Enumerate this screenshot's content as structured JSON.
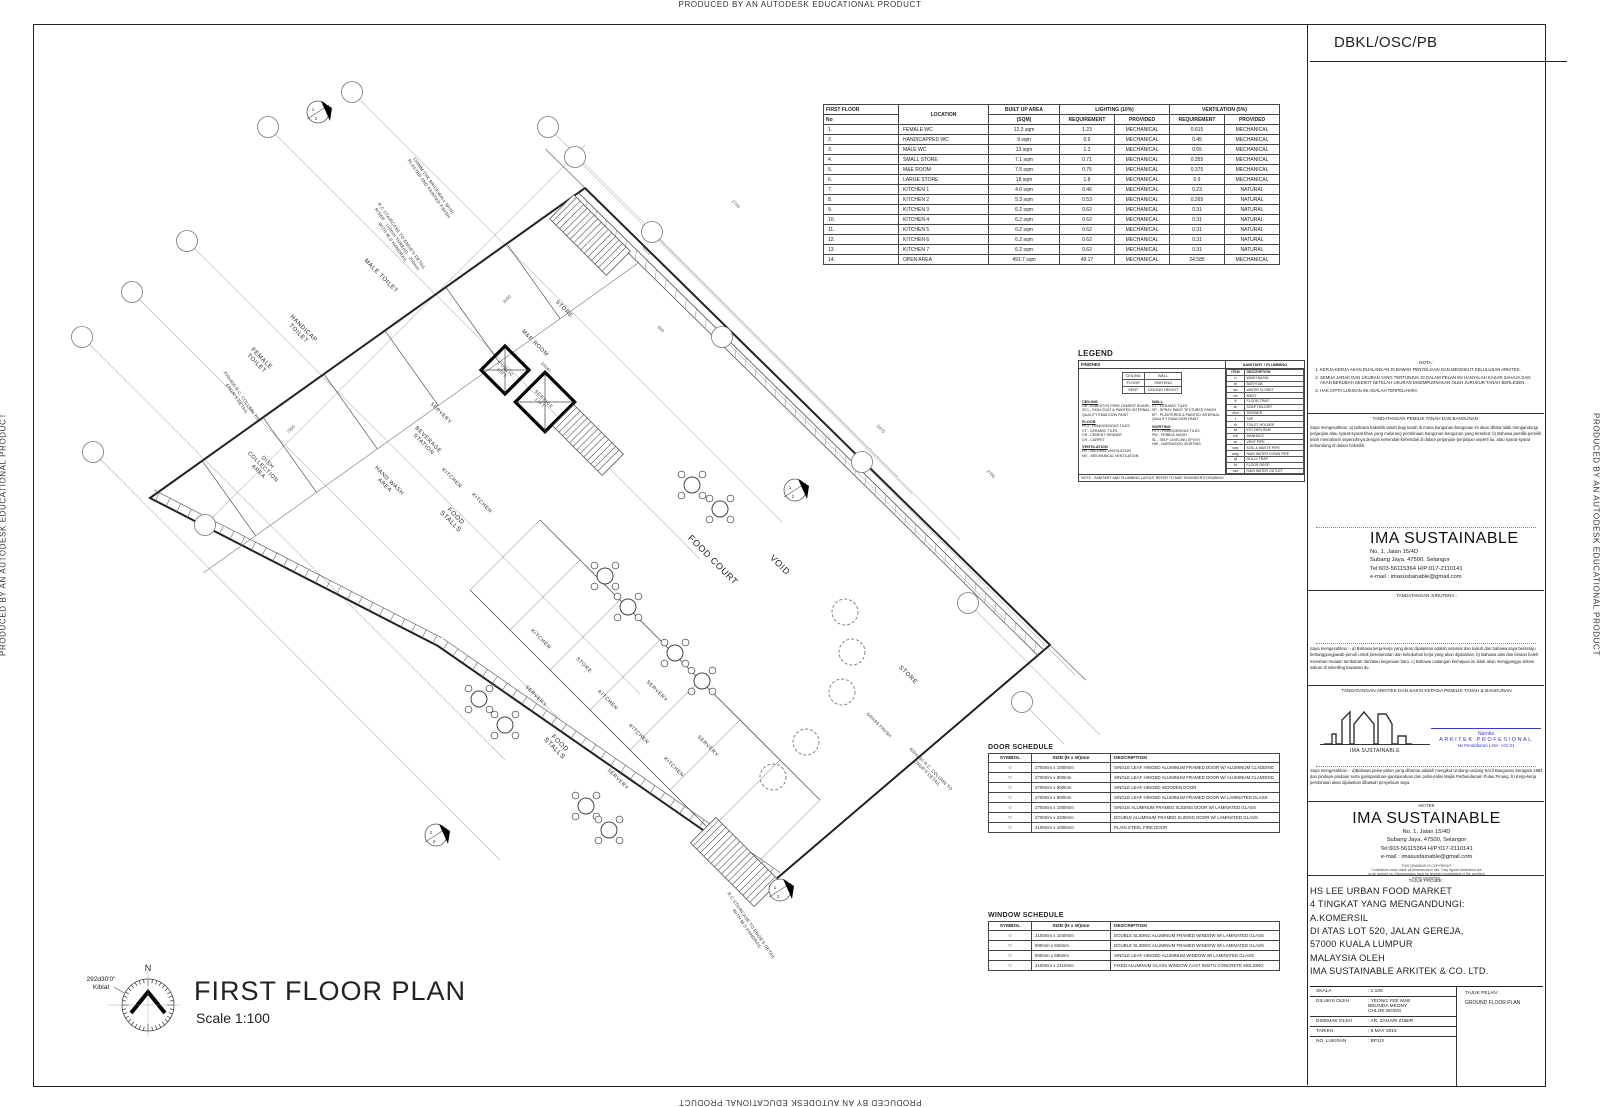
{
  "edge_text": "PRODUCED BY AN AUTODESK EDUCATIONAL PRODUCT",
  "title_block": {
    "header": "DBKL/OSC/PB",
    "nota_title": "NOTA :",
    "nota_items": [
      "KERJA-KERJA AKAN DIJALANKAN DI BAWAH PENYELIAAN DAN MENGIKUT KELULUSAN ARKITEK.",
      "SEMUA JARAK DAN UKURAN YANG TERTUNJUK DI DALAM PELAN INI HANYALAH KASAR SAHAJA DAN AKAN BERUBAH SEDIKIT SETELAH UKURAN DISEMPURNAKAN OLEH JURUKUR TANAH BERLESEN.",
      "HAK CIPTA LUKISAN INI ADALAH TERPELIHARA"
    ],
    "owner_title": "TANDATANGAN PEMILIK TANAH DAN BANGUNAN :",
    "owner_para": "Saya mengesahkan:  a) bahawa hakmilik tanah bagi tanah di mana bangunan-bangunan ini akan dibina tidak  mengandungi perjanjian atau syarat-syarat khas yang melarang pembinaan bangunan-bangunan yang tersebut; b) Bahawa pemilik-pemilik telah memahami sepenuhnya dengan kehendak-kehendak di dalam perjanjian-perjanjian seperti itu, atau syarat-syarat terkandung di dalam hakmilik.",
    "firm_name": "IMA SUSTAINABLE",
    "firm_address": [
      "No. 1, Jalan 15/4D",
      "Subang Jaya, 47500, Selangor",
      "Tel:603-56115364  H/P:017-2110141",
      "e-mail : imasustainable@gmail.com"
    ],
    "jurutera_title": "TANDATANGAN JURUTERA :",
    "engineer_para": "Saya mengesahkan :-  a) Bahawa kerja-kerja yang akan dijalankan adalah selamat dan kukuh dan bahawa saya bersetuju  bertanggungjawab penuh untuk keselamatan dan kekukuhan kerja yang akan dijalankan.  b) Bahawa alas dan binaan boleh menahan muatan tambahan dan/atau kegunaan baru.  c) Bahawa cadangan kemajuan ini tidak akan mengganggu sistem saliran di sekeliling kawasan itu.",
    "arkitek_saksi_title": "TANDATANGAN ARKITEK DAN SAKSI KEPADA PEMILIK TANAH & BANGUNAN",
    "logo_caption": "IMA SUSTAINABLE",
    "registration": {
      "name": "Naroka",
      "line2": "ARKITEK PROFESIONAL",
      "line3": "No Pendaftaran LAM : A/O 01",
      "color": "#3a3ac8"
    },
    "architect_para": "Saya mengesahkan :-  a)Bahawa pelan-pelan yang dihantar adalah mengikut Undang-undang Kecil Bangunan Seragam 1984 dan pindaan-pindaan serta garispanduan-garispanduan dan polisi-polisi Majlis Perbandaraan Pulau Pinang.  b) Kerja-kerja pembinaan akan dijalankan dibawah penyeliaan saya.",
    "akitek_label": "AKITEK",
    "copyright_lines": [
      "THIS DRAWING IS COPYRIGHT",
      "Contractors must check all dimensions in site. Only figured dimension are",
      "to be worked on. Discrepancies must be reported immediately to the architect",
      "before proceeding."
    ],
    "project_title_label": "TAJUK PROJEK :",
    "project_lines": [
      "HS LEE URBAN FOOD MARKET",
      "4 TINGKAT YANG MENGANDUNGI:",
      "A.KOMERSIL",
      "DI ATAS LOT 520, JALAN GEREJA,",
      "57000 KUALA LUMPUR",
      "MALAYSIA OLEH",
      "IMA SUSTAINABLE ARKITEK & CO. LTD."
    ],
    "meta_rows": [
      [
        "SKALA",
        "1:100"
      ],
      [
        "DILUKIS OLEH",
        "YEONG YEE MAE\nBELINDA MKONY\nCHLOE WONG"
      ],
      [
        "DISEMAK OLEH",
        "AR. ZAHARI ZUBIR"
      ],
      [
        "TARIKH",
        "6 MAY 2015"
      ],
      [
        "NO. LUKISAN",
        "BP1/3"
      ]
    ],
    "tajuk_pelan_label": "TAJUK PELAN :",
    "tajuk_pelan_value": "GROUND FLOOR PLAN"
  },
  "area_table": {
    "h_first_floor": "FIRST FLOOR",
    "h_no": "No",
    "h_location": "LOCATION",
    "h_area1": "BUILT UP AREA",
    "h_area2": "(SQM)",
    "h_lighting": "LIGHTING (10%)",
    "h_vent": "VENTILATION (5%)",
    "h_req": "REQUIREMENT",
    "h_prov": "PROVIDED",
    "rows": [
      [
        "1.",
        "FEMALE WC",
        "12.3 sqm",
        "1.23",
        "MECHANICAL",
        "0.615",
        "MECHANICAL"
      ],
      [
        "2.",
        "HANDICAPPED WC",
        "9 sqm",
        "0.9",
        "MECHANICAL",
        "0.45",
        "MECHANICAL"
      ],
      [
        "3.",
        "MALE WC",
        "13 sqm",
        "1.3",
        "MECHANICAL",
        "0.65",
        "MECHANICAL"
      ],
      [
        "4.",
        "SMALL STORE",
        "7.1 sqm",
        "0.71",
        "MECHANICAL",
        "0.355",
        "MECHANICAL"
      ],
      [
        "5.",
        "M&E ROOM",
        "7.5 sqm",
        "0.75",
        "MECHANICAL",
        "0.375",
        "MECHANICAL"
      ],
      [
        "6.",
        "LARGE STORE",
        "18 sqm",
        "1.8",
        "MECHANICAL",
        "0.9",
        "MECHANICAL"
      ],
      [
        "7.",
        "KITCHEN 1",
        "4.6 sqm",
        "0.46",
        "MECHANICAL",
        "0.23",
        "NATURAL"
      ],
      [
        "8.",
        "KITCHEN 2",
        "5.3 sqm",
        "0.53",
        "MECHANICAL",
        "0.265",
        "NATURAL"
      ],
      [
        "9.",
        "KITCHEN 3",
        "6.2 sqm",
        "0.62",
        "MECHANICAL",
        "0.31",
        "NATURAL"
      ],
      [
        "10.",
        "KITCHEN 4",
        "6.2 sqm",
        "0.62",
        "MECHANICAL",
        "0.31",
        "NATURAL"
      ],
      [
        "11.",
        "KITCHEN 5",
        "6.2 sqm",
        "0.62",
        "MECHANICAL",
        "0.31",
        "NATURAL"
      ],
      [
        "12.",
        "KITCHEN 6",
        "6.2 sqm",
        "0.62",
        "MECHANICAL",
        "0.31",
        "NATURAL"
      ],
      [
        "13.",
        "KITCHEN 7",
        "6.2 sqm",
        "0.62",
        "MECHANICAL",
        "0.31",
        "NATURAL"
      ],
      [
        "14.",
        "OPEN AREA",
        "491.7 sqm",
        "49.17",
        "MECHANICAL",
        "24.585",
        "MECHANICAL"
      ]
    ]
  },
  "legend": {
    "title": "LEGEND",
    "finishes_header": "FINISHES",
    "matrix": [
      [
        "CEILING",
        "WALL"
      ],
      [
        "FLOOR",
        "SKIRTING"
      ],
      [
        "VENT",
        "CEILING HEIGHT"
      ]
    ],
    "col_a": [
      {
        "title": "CEILING",
        "items": [
          "CB - ASBESTOS FREE CEMENT BOARD",
          "SC1 - SKIN COAT & PAINTED INTERNAL QUALITY EMULSION PAINT"
        ]
      },
      {
        "title": "FLOOR",
        "items": [
          "HT3 - HOMOGENOUS TILES",
          "CT - CERAMIC TILES",
          "CR - CEMENT RENDER",
          "CH - CARPET"
        ]
      },
      {
        "title": "VENTILATION",
        "items": [
          "NV - NATURAL VENTILATION",
          "MV - MECHANICAL VENTILATION"
        ]
      }
    ],
    "col_b": [
      {
        "title": "WALL",
        "items": [
          "CT - CERAMIC TILES",
          "SP - SPRAY PAINT TEXTURED FINISH",
          "EP - PLASTERED & PAINTED INTERNAL QUALITY EMULSION PAINT"
        ]
      },
      {
        "title": "SKIRTING",
        "items": [
          "HT3 - HOMOGENOUS TILES",
          "PW - PEBBLE WASH",
          "SL - SELF LEVELING EPOXY",
          "HW - HARDWOOD SKIRTING"
        ]
      }
    ],
    "sanitary": {
      "header": "SANITARY / PLUMBING",
      "h_item": "ITEM",
      "h_desc": "DESCRIPTION",
      "rows": [
        [
          "b",
          "WASH BASIN"
        ],
        [
          "bt",
          "BATHTUB"
        ],
        [
          "wc",
          "WATER CLOSET"
        ],
        [
          "bd",
          "BIDET"
        ],
        [
          "ft",
          "FLOOR TRAP"
        ],
        [
          "sh",
          "SOAP HOLDER"
        ],
        [
          "shw",
          "SHOWER"
        ],
        [
          "t",
          "TAP"
        ],
        [
          "th",
          "TOILET HOLDER"
        ],
        [
          "ks",
          "KITCHEN SINK"
        ],
        [
          "mh",
          "MANHOLE"
        ],
        [
          "vp",
          "VENT PIPE"
        ],
        [
          "swp",
          "SOIL & WASTE PIPE"
        ],
        [
          "rwdp",
          "RAIN WATER DOWN PIPE"
        ],
        [
          "gt",
          "GULLY TRAP"
        ],
        [
          "fd",
          "FLOOR DROP"
        ],
        [
          "rwo",
          "RAIN WATER OUTLET"
        ]
      ]
    },
    "note": "NOTE : SANITARY AND PLUMBING LAYOUT REFER TO M&E ENGINEER'S DRAWING"
  },
  "door_schedule": {
    "title": "DOOR SCHEDULE",
    "h_symbol": "SYMBOL",
    "h_size": "SIZE (H x W)mm",
    "h_desc": "DESCRIPTION",
    "rows": [
      [
        "○",
        "2700mm x 1000mm",
        "SINGLE LEAF HINGED ALUMINUM FRAMED DOOR W/ ALUMINUM CLADDING"
      ],
      [
        "○",
        "2700mm x 800mm",
        "SINGLE LEAF HINGED ALUMINUM FRAMED DOOR W/ ALUMINUM CLADDING"
      ],
      [
        "○",
        "2700mm x 900mm",
        "SINGLE LEAF HINGED WOODEN DOOR"
      ],
      [
        "○",
        "2700mm x 900mm",
        "SINGLE LEAF HINGED ALUMINUM FRAMED DOOR W/ LAMINATED GLASS"
      ],
      [
        "○",
        "2700mm x 1000mm",
        "SINGLE ALUMINUM FRAMED SLIDING DOOR W/ LAMINATED GLASS"
      ],
      [
        "○",
        "2700mm x 2200mm",
        "DOUBLE ALUMINUM FRAMED SLIDING DOOR W/ LAMINATED GLASS"
      ],
      [
        "○",
        "2100mm x 1000mm",
        "PLAIN STEEL FIRE DOOR"
      ]
    ]
  },
  "window_schedule": {
    "title": "WINDOW SCHEDULE",
    "h_symbol": "SYMBOL",
    "h_size": "SIZE (H x W)mm",
    "h_desc": "DESCRIPTION",
    "rows": [
      [
        "○",
        "2100mm x 1040mm",
        "DOUBLE SLIDING ALUMINUM FRAMED WINDOW W/ LAMINATED GLASS"
      ],
      [
        "○",
        "900mm x 840mm",
        "DOUBLE SLIDING ALUMINUM FRAMED WINDOW W/ LAMINATED GLASS"
      ],
      [
        "○",
        "900mm x 580mm",
        "SINGLE LEAF HINGED ALUMINUM WINDOW W/ LAMINATED GLASS"
      ],
      [
        "○",
        "2100mm x 1410mm",
        "FIXED ALUMINUM GLASS WINDOW CAST INSITU CONCRETE MOLDING"
      ]
    ]
  },
  "plan": {
    "title": "FIRST FLOOR PLAN",
    "scale": "Scale 1:100",
    "north_label": "N",
    "kiblat": "292d30'0\"\nKiblat",
    "outline": [
      [
        150,
        498
      ],
      [
        585,
        188
      ],
      [
        1050,
        645
      ],
      [
        775,
        880
      ],
      [
        438,
        646
      ]
    ],
    "labels": [
      {
        "t": "MALE TOILET",
        "x": 380,
        "y": 277,
        "r": 45,
        "s": 6
      },
      {
        "t": "HANDICAP\nTOILET",
        "x": 300,
        "y": 332,
        "r": 45,
        "s": 6
      },
      {
        "t": "FEMALE\nTOILET",
        "x": 258,
        "y": 362,
        "r": 45,
        "s": 6
      },
      {
        "t": "DISH\nCOLLECTION\nAREA",
        "x": 262,
        "y": 468,
        "r": 45,
        "s": 5.5
      },
      {
        "t": "BEVERAGE\nSTATION",
        "x": 425,
        "y": 443,
        "r": 45,
        "s": 5.5
      },
      {
        "t": "HAND WASH\nAREA",
        "x": 386,
        "y": 484,
        "r": 45,
        "s": 5.5
      },
      {
        "t": "SERVERY",
        "x": 440,
        "y": 414,
        "r": 45,
        "s": 5
      },
      {
        "t": "KITCHEN",
        "x": 451,
        "y": 479,
        "r": 45,
        "s": 5
      },
      {
        "t": "KITCHEN",
        "x": 481,
        "y": 504,
        "r": 45,
        "s": 5
      },
      {
        "t": "FOOD\nSTALLS",
        "x": 452,
        "y": 520,
        "r": 45,
        "s": 6.5
      },
      {
        "t": "STORE",
        "x": 563,
        "y": 310,
        "r": 45,
        "s": 5.5
      },
      {
        "t": "M&E ROOM",
        "x": 534,
        "y": 344,
        "r": 45,
        "s": 5.5
      },
      {
        "t": "PUBLIC\nLIFT",
        "x": 503,
        "y": 372,
        "r": 45,
        "s": 4.5
      },
      {
        "t": "SERVICE\nLIFT",
        "x": 541,
        "y": 402,
        "r": 45,
        "s": 4.5
      },
      {
        "t": "FOOD COURT",
        "x": 711,
        "y": 562,
        "r": 45,
        "s": 9
      },
      {
        "t": "VOID",
        "x": 778,
        "y": 567,
        "r": 45,
        "s": 9
      },
      {
        "t": "STORE",
        "x": 907,
        "y": 676,
        "r": 45,
        "s": 6
      },
      {
        "t": "KITCHEN",
        "x": 540,
        "y": 640,
        "r": 45,
        "s": 5
      },
      {
        "t": "STORE",
        "x": 583,
        "y": 666,
        "r": 45,
        "s": 5
      },
      {
        "t": "KITCHEN",
        "x": 607,
        "y": 701,
        "r": 45,
        "s": 5
      },
      {
        "t": "SERVERY",
        "x": 656,
        "y": 692,
        "r": 45,
        "s": 5
      },
      {
        "t": "SERVERY",
        "x": 535,
        "y": 697,
        "r": 45,
        "s": 5
      },
      {
        "t": "KITCHEN",
        "x": 638,
        "y": 735,
        "r": 45,
        "s": 5
      },
      {
        "t": "KITCHEN",
        "x": 673,
        "y": 768,
        "r": 45,
        "s": 5
      },
      {
        "t": "SERVERY",
        "x": 707,
        "y": 747,
        "r": 45,
        "s": 5
      },
      {
        "t": "SERVERY",
        "x": 617,
        "y": 780,
        "r": 45,
        "s": 5
      },
      {
        "t": "FOOD\nSTALLS",
        "x": 556,
        "y": 747,
        "r": 45,
        "s": 6.5
      }
    ],
    "annotations": [
      {
        "t": "150MM THK BRICKWALL WITH\nPLASTER AND PAINTED FINISH",
        "x": 430,
        "y": 188,
        "r": 55,
        "s": 4.4
      },
      {
        "t": "R.C STAIRCASE TO ENGR'S DETAIL\nRISER : 150mm THREAD : 250mm\nWITH M.S HANDRAIL",
        "x": 396,
        "y": 240,
        "r": 55,
        "s": 4.4
      },
      {
        "t": "250x400 R.C. COLUMN TO\nENGR'S DETAIL",
        "x": 238,
        "y": 398,
        "r": 55,
        "s": 4.4
      },
      {
        "t": "GRASS FINISH",
        "x": 878,
        "y": 726,
        "r": 45,
        "s": 4.4
      },
      {
        "t": "400x450 R.C. COLUMN TO\nENGR'S DETAIL",
        "x": 928,
        "y": 772,
        "r": 45,
        "s": 4.4
      },
      {
        "t": "R.C STAIRCASE TO ENGR'S DETAIL\nWITH M.S HANDRAIL",
        "x": 748,
        "y": 928,
        "r": 55,
        "s": 4.4
      }
    ],
    "dimensions": [
      {
        "t": "35040",
        "x": 545,
        "y": 368,
        "r": 45
      },
      {
        "t": "7500",
        "x": 292,
        "y": 430,
        "r": -45
      },
      {
        "t": "6570",
        "x": 646,
        "y": 252,
        "r": 45
      },
      {
        "t": "3050",
        "x": 508,
        "y": 300,
        "r": -45
      },
      {
        "t": "2700",
        "x": 735,
        "y": 205,
        "r": 45
      },
      {
        "t": "600",
        "x": 660,
        "y": 330,
        "r": 45
      },
      {
        "t": "5470",
        "x": 880,
        "y": 430,
        "r": 45
      },
      {
        "t": "2790",
        "x": 990,
        "y": 475,
        "r": 45
      }
    ],
    "grid": [
      {
        "x": 82,
        "y": 337,
        "ex": 505,
        "ey": 760
      },
      {
        "x": 132,
        "y": 292,
        "ex": 560,
        "ey": 720
      },
      {
        "x": 187,
        "y": 241,
        "ex": 640,
        "ey": 694
      },
      {
        "x": 268,
        "y": 127,
        "ex": 700,
        "ey": 559
      },
      {
        "x": 352,
        "y": 92,
        "ex": 782,
        "ey": 522
      },
      {
        "x": 548,
        "y": 127,
        "ex": 898,
        "ey": 477
      },
      {
        "x": 575,
        "y": 157,
        "ex": 912,
        "ey": 494
      },
      {
        "x": 652,
        "y": 232,
        "ex": 960,
        "ey": 540
      },
      {
        "x": 722,
        "y": 337,
        "ex": 1005,
        "ey": 620
      },
      {
        "x": 862,
        "y": 462,
        "ex": 1075,
        "ey": 675
      },
      {
        "x": 968,
        "y": 603,
        "ex": 1100,
        "ey": 735
      },
      {
        "x": 1022,
        "y": 702,
        "ex": 1110,
        "ey": 790
      },
      {
        "x": 205,
        "y": 525,
        "ex": 585,
        "ey": 145
      },
      {
        "x": 93,
        "y": 452,
        "ex": 500,
        "ey": 860
      }
    ],
    "tables": [
      [
        692,
        485
      ],
      [
        720,
        509
      ],
      [
        628,
        607
      ],
      [
        675,
        653
      ],
      [
        702,
        681
      ],
      [
        479,
        699
      ],
      [
        505,
        725
      ],
      [
        586,
        806
      ],
      [
        609,
        830
      ],
      [
        605,
        576
      ]
    ],
    "trees": [
      [
        845,
        612
      ],
      [
        852,
        652
      ],
      [
        842,
        692
      ],
      [
        806,
        742
      ],
      [
        773,
        777
      ]
    ],
    "stairs": [
      {
        "x": 590,
        "y": 235,
        "w": 80,
        "h": 34
      },
      {
        "x": 588,
        "y": 440,
        "w": 70,
        "h": 30
      },
      {
        "x": 735,
        "y": 862,
        "w": 90,
        "h": 36
      }
    ],
    "lifts": [
      {
        "x": 505,
        "y": 370,
        "s": 34
      },
      {
        "x": 545,
        "y": 402,
        "s": 42
      }
    ],
    "band": [
      [
        470,
        590,
        750,
        870
      ],
      [
        540,
        520,
        820,
        800
      ]
    ],
    "markers": [
      {
        "x": 318,
        "y": 112,
        "n1": "1",
        "n2": "2"
      },
      {
        "x": 795,
        "y": 490,
        "n1": "1",
        "n2": "2"
      },
      {
        "x": 436,
        "y": 835,
        "n1": "2",
        "n2": "2"
      },
      {
        "x": 780,
        "y": 890,
        "n1": "1",
        "n2": "2"
      }
    ]
  }
}
